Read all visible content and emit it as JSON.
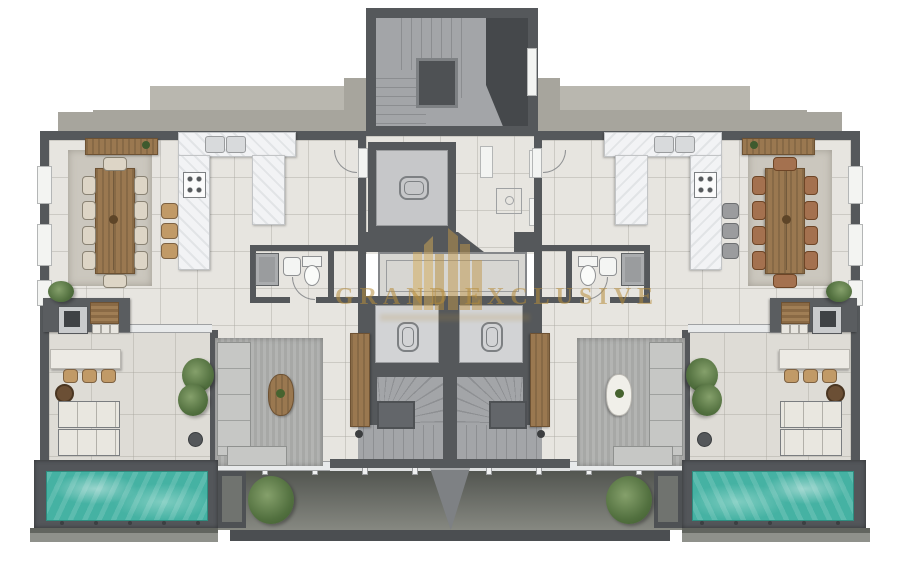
{
  "watermark": {
    "title": "GRAND EXCLUSIVE",
    "logo": "gold-buildings-icon"
  },
  "palette": {
    "wall": "#55585b",
    "slab": "#a7a59d",
    "slab_light": "#b9b7af",
    "interior_floor": "#e7e5e0",
    "terrace_floor": "#dedcd6",
    "stair_floor": "#a3a5a8",
    "pool_water": "#45b2a3",
    "pool_deck": "#53565a",
    "wood": "#9a7850",
    "marble": "#f2f3f5",
    "dining_rug": "#cbc7be",
    "living_rug": "#a7a8a6",
    "balcony_dark": "#5b5e58",
    "watermark_gold": "#b78d3c"
  },
  "plan": {
    "type": "residential-floor-plan-top-view",
    "units": [
      {
        "id": "left",
        "features": [
          "dining-table-10-seats",
          "sideboard",
          "u-shaped-kitchen",
          "bar-stools",
          "guest-wc",
          "living-sofa",
          "coffee-table",
          "tv-wardrobe",
          "outdoor-bbq",
          "outdoor-bar",
          "sun-loungers",
          "terrace-tree",
          "private-pool"
        ]
      },
      {
        "id": "right",
        "features": [
          "dining-table-10-seats",
          "sideboard",
          "u-shaped-kitchen",
          "bar-stools",
          "guest-wc",
          "living-sofa",
          "coffee-table",
          "tv-wardrobe",
          "outdoor-bbq",
          "outdoor-bar",
          "sun-loungers",
          "terrace-tree",
          "private-pool"
        ]
      }
    ],
    "core": [
      "stairwell-tower",
      "elevator-machine-room",
      "lobby",
      "skylight-void",
      "elevator-left",
      "elevator-right",
      "winder-stair-left",
      "winder-stair-right",
      "rear-balcony",
      "divider-fin"
    ]
  }
}
